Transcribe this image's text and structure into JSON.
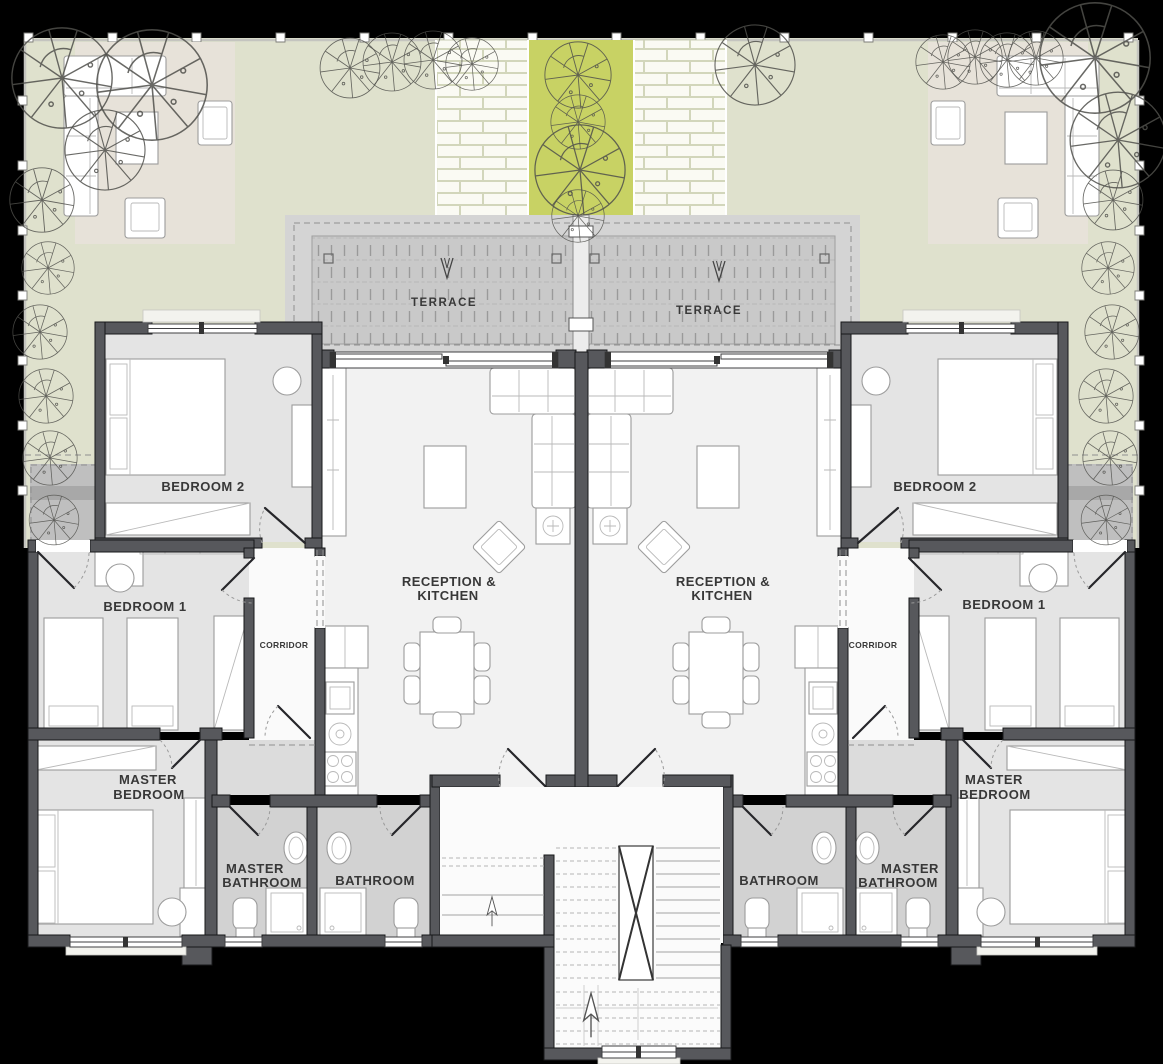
{
  "plan": {
    "terrace_left": "TERRACE",
    "terrace_right": "TERRACE",
    "left": {
      "bedroom2": "BEDROOM 2",
      "bedroom1": "BEDROOM 1",
      "corridor": "CORRIDOR",
      "reception_line1": "RECEPTION &",
      "reception_line2": "KITCHEN",
      "master_bedroom_line1": "MASTER",
      "master_bedroom_line2": "BEDROOM",
      "master_bathroom_line1": "MASTER",
      "master_bathroom_line2": "BATHROOM",
      "bathroom": "BATHROOM"
    },
    "right": {
      "bedroom2": "BEDROOM 2",
      "bedroom1": "BEDROOM 1",
      "corridor": "CORRIDOR",
      "reception_line1": "RECEPTION &",
      "reception_line2": "KITCHEN",
      "master_bedroom_line1": "MASTER",
      "master_bedroom_line2": "BEDROOM",
      "master_bathroom_line1": "MASTER",
      "master_bathroom_line2": "BATHROOM",
      "bathroom": "BATHROOM"
    }
  },
  "colors": {
    "c-bg": "#000000",
    "c-garden": "#dfe1cd",
    "c-patio": "#e7e2d9",
    "c-lime": "#c8d264",
    "c-terrace": "#d4d4d4",
    "c-terrace_inner": "#c9c9c9",
    "c-wall": "#57585c",
    "c-floor": "#f2f2f2",
    "c-floor_bedroom": "#e4e4e4",
    "c-floor_bath": "#d2d2d2",
    "c-floor_corridor": "#fafafa",
    "c-floor_vestibule": "#dcdcdc",
    "c-entry": "#bfbfbf",
    "c-label": "#383838",
    "c-tree": "#50504c"
  }
}
